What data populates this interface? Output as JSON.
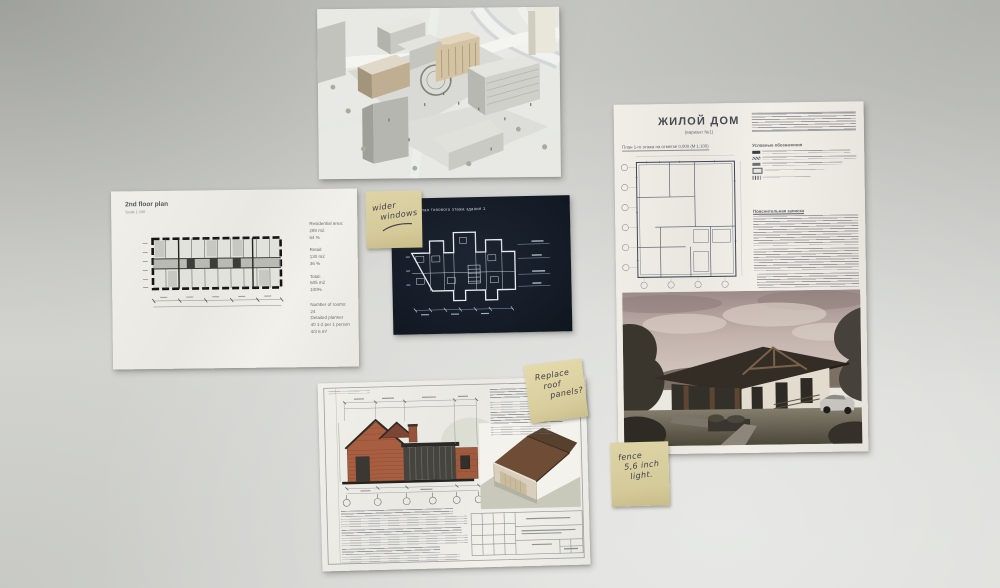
{
  "wall": {
    "color": "#d4d5d1"
  },
  "floor_plan_sheet": {
    "title": "2nd floor plan",
    "subtitle": "Scale 1:100",
    "info_groups": [
      {
        "lines": [
          "Residential area:",
          "289 m2",
          "64 %"
        ]
      },
      {
        "lines": [
          "Retail:",
          "130 m2",
          "36 %"
        ]
      },
      {
        "lines": [
          "Total:",
          "605 m2",
          "100%"
        ]
      },
      {
        "lines": [
          "Number of rooms: 24",
          "Detailed planner",
          "40 1-2 per 1 person",
          "4/3 6 m²"
        ]
      }
    ]
  },
  "blueprint_sheet": {
    "title": "план типового этажа здания 1"
  },
  "house_sheet": {
    "title": "ЖИЛОЙ ДОМ",
    "subtitle": "(вариант №1)",
    "plan_caption": "План 1-го этажа на отметке 0,000 (М 1:100)",
    "legend_title": "Условные обозначения",
    "notes_title": "Пояснительная записка"
  },
  "sticky_notes": {
    "note1": {
      "lines": [
        "wider",
        "windows"
      ]
    },
    "note2": {
      "lines": [
        "Replace",
        "roof",
        "panels?"
      ]
    },
    "note3": {
      "lines": [
        "fence",
        "5,6 inch",
        "light."
      ]
    }
  },
  "colors": {
    "sticky_yellow": "#d7cc9c",
    "blueprint_navy": "#141b26",
    "brick_red": "#a85e41",
    "sepia_sky": "#c2b2ab"
  }
}
